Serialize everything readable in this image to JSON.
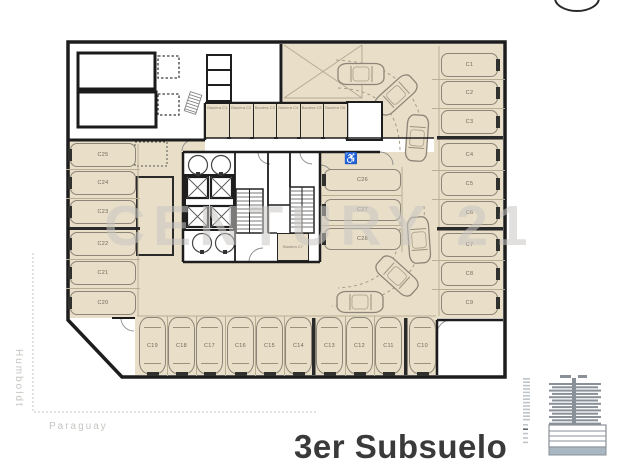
{
  "page": {
    "title": "3er Subsuelo",
    "watermark": "CENTURY 21"
  },
  "streets": {
    "left": "Humboldt",
    "bottom": "Paraguay"
  },
  "floor_plan": {
    "parking_spots": {
      "left_column": [
        "C25",
        "C24",
        "C23",
        "C22",
        "C21",
        "C20"
      ],
      "middle_column": [
        "C26",
        "C27",
        "C28"
      ],
      "right_column": [
        "C1",
        "C2",
        "C3",
        "C4",
        "C5",
        "C6",
        "C7",
        "C8",
        "C9"
      ],
      "bottom_row": [
        "C19",
        "C18",
        "C17",
        "C16",
        "C15",
        "C14",
        "C13",
        "C12",
        "C11",
        "C10"
      ]
    },
    "storage_rooms": {
      "top_row": [
        "Baulera C1",
        "Baulera C2",
        "Baulera C3",
        "Baulera C4",
        "Baulera C5",
        "Baulera C6"
      ],
      "core_room": "Baulera C7"
    },
    "accessible_icon": "♿",
    "accessible_spot": "C26"
  },
  "colors": {
    "parking_fill": "#e9dec7",
    "wall": "#1d1d1d",
    "spot_outline": "#8d8577",
    "watermark": "#c9c7c4",
    "street_text": "#c6c4c1",
    "title_text": "#3a3a3a",
    "building_icon": "#899098",
    "building_base": "#a9b7c3"
  }
}
